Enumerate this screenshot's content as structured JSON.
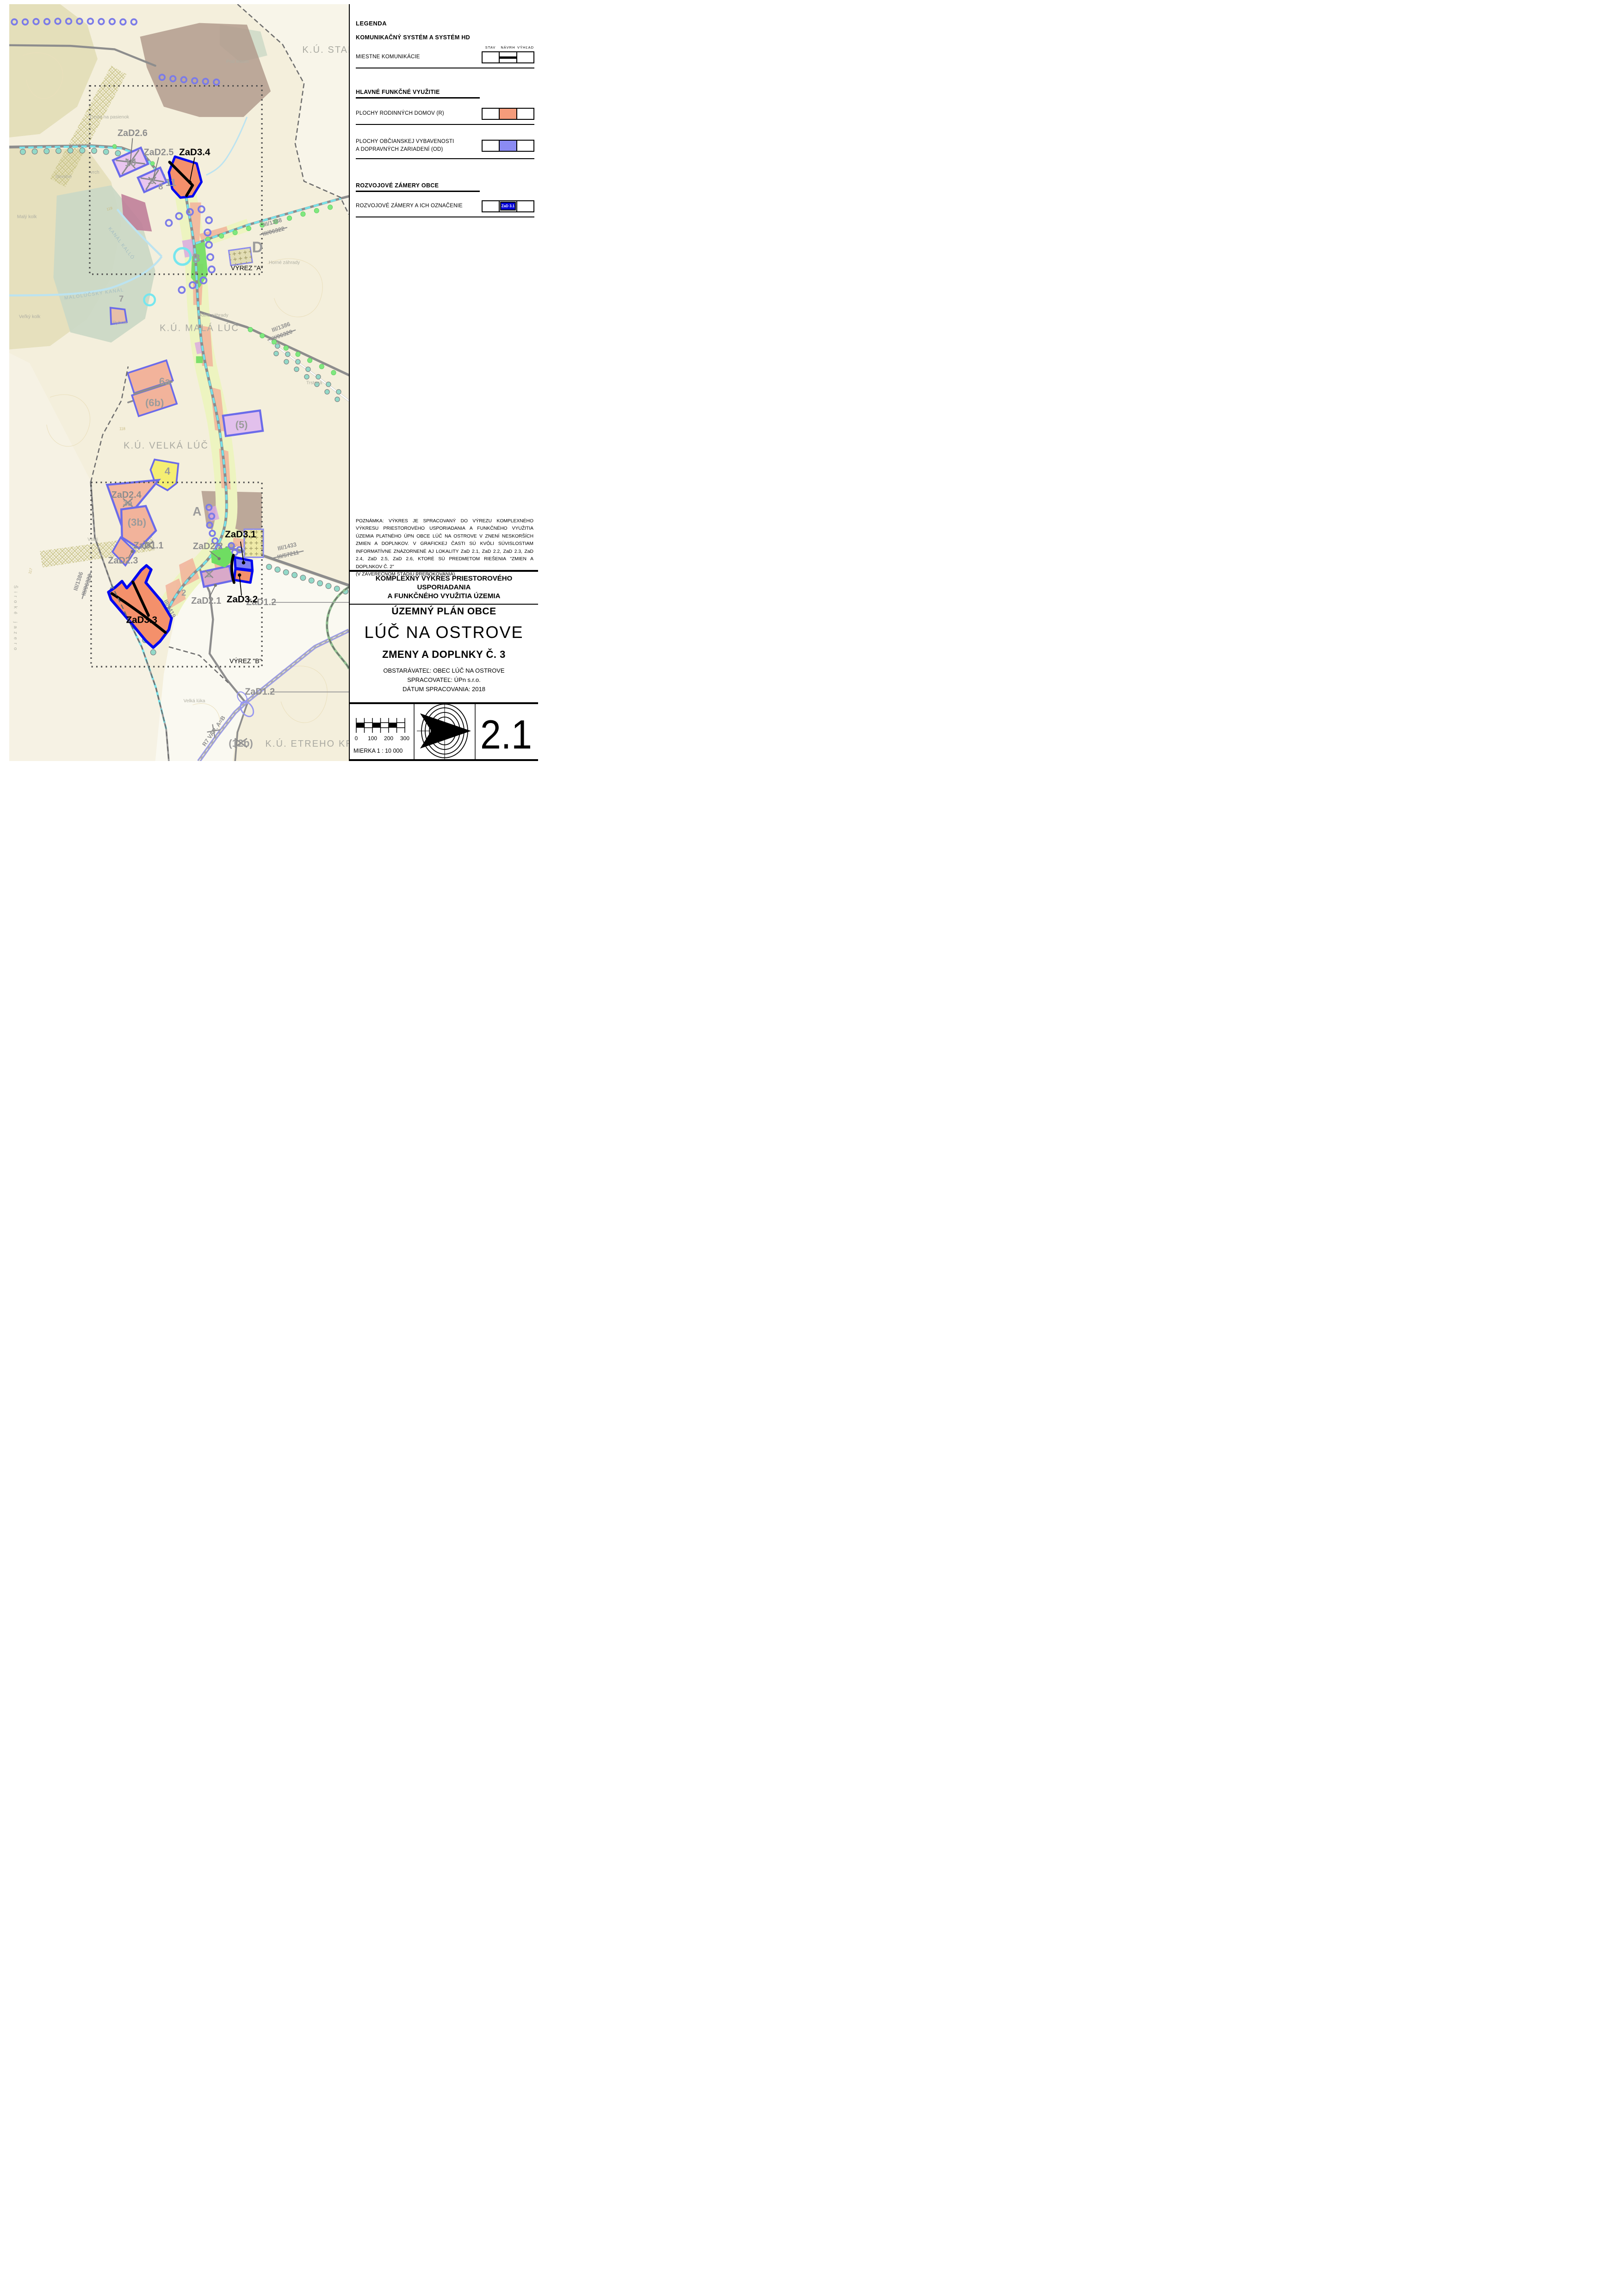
{
  "sheet": {
    "number": "2.1",
    "scale_label": "MIERKA 1 : 10 000",
    "scale_ticks": [
      "0",
      "100",
      "200",
      "300"
    ]
  },
  "legend": {
    "title": "LEGENDA",
    "columns": [
      "STAV",
      "NÁVRH",
      "VÝHĽAD"
    ],
    "sections": [
      {
        "title": "KOMUNIKAČNÝ SYSTÉM A SYSTÉM HD",
        "rows": [
          {
            "label": "MIESTNE KOMUNIKÁCIE",
            "symbol": "road-line"
          }
        ]
      },
      {
        "title": "HLAVNÉ FUNKČNÉ VYUŽITIE",
        "rows": [
          {
            "label": "PLOCHY RODINNÝCH DOMOV (R)",
            "symbol": "swatch",
            "color": "#F59C7B"
          },
          {
            "label": "PLOCHY OBČIANSKEJ VYBAVENOSTI",
            "label2": "A DOPRAVNÝCH ZARIADENÍ (OD)",
            "symbol": "swatch",
            "color": "#8B8BF3"
          }
        ]
      },
      {
        "title": "ROZVOJOVÉ ZÁMERY OBCE",
        "rows": [
          {
            "label": "ROZVOJOVÉ ZÁMERY A ICH OZNAČENIE",
            "symbol": "zad-box",
            "color": "#0000D6",
            "text": "ZaD 3.1"
          }
        ]
      }
    ]
  },
  "note": {
    "text": "POZNÁMKA: VÝKRES  JE SPRACOVANÝ DO VÝREZU KOMPLEXNÉHO VÝKRESU PRIESTOROVÉHO USPORIADANIA A FUNKČNÉHO VYUŽITIA ÚZEMIA  PLATNÉHO ÚPN OBCE LÚČ NA OSTROVE V ZNENÍ NESKORŠÍCH ZMIEN A DOPLNKOV. V GRAFICKEJ ČASTI SÚ KVÔLI SÚVISLOSTIAM INFORMATÍVNE ZNÁZORNENÉ AJ LOKALITY ZaD 2.1, ZaD 2.2, ZaD 2.3, ZaD 2.4, ZaD 2.5, ZaD 2.6, KTORÉ SÚ PREDMETOM RIEŠENIA \"ZMIEN A DOPLNKOV Č. 2\"",
    "text2": "(V ZÁVEREČNOM ŠTÁDIU PREROKOVANIA)."
  },
  "titles": {
    "block1_line1": "KOMPLEXNÝ VÝKRES PRIESTOROVÉHO",
    "block1_line2": "USPORIADANIA",
    "block1_line3": "A FUNKČNÉHO VYUŽITIA ÚZEMIA",
    "plan_type": "ÚZEMNÝ PLÁN OBCE",
    "municipality": "LÚČ NA OSTROVE",
    "amendment": "ZMENY A DOPLNKY Č. 3",
    "client": "OBSTARÁVATEĽ: OBEC LÚČ NA OSTROVE",
    "author": "SPRACOVATEĽ: ÚPn s.r.o.",
    "date": "DÁTUM  SPRACOVANIA: 2018"
  },
  "map": {
    "labels": {
      "ku_stara": "K.Ú. STARÁ",
      "ku_mala": "K.Ú. MALÁ LÚČ",
      "ku_velka": "K.Ú. VELKÁ LÚČ",
      "ku_etreho": "K.Ú. ETREHO KRAČA",
      "zad2_6": "ZaD2.6",
      "zad2_5": "ZaD2.5",
      "zad2_4": "ZaD2.4",
      "zad2_3": "ZaD2.3",
      "zad2_2": "ZaD2.2",
      "zad2_1": "ZaD2.1",
      "zad1_1": "ZaD1.1",
      "zad1_2a": "ZaD1.2",
      "zad1_2b": "ZaD1.2",
      "zad3_1": "ZaD3.1",
      "zad3_2": "ZaD3.2",
      "zad3_3": "ZaD3.3",
      "zad3_4": "ZaD3.4",
      "n10": "10",
      "n9": "9",
      "n11": "11",
      "n8": "8",
      "n7": "7",
      "n6a": "6a",
      "n6b": "(6b)",
      "n5": "(5)",
      "n4": "4",
      "n3a": "3a",
      "n3b": "(3b)",
      "n2a": "2",
      "n2b": "2",
      "n12b": "(12b)",
      "letter_d": "D",
      "letter_b": "B",
      "letter_a": "A",
      "r1388": "III/1388",
      "r06322": "III/06322",
      "r1386a": "III/1386",
      "r06320a": "III/06320",
      "r1386b": "III/1386",
      "r06320b": "III/06320",
      "r1433": "III/1433",
      "r57211": "III/57211",
      "r1419": "III/1419",
      "r7": "R7 VAR. A=B",
      "vyrez_a": "VÝREZ \"A\"",
      "vyrez_b": "VÝREZ \"B\"",
      "horne": "Horné záhrady",
      "dolne": "Dolné záhrady",
      "velka_luka": "Velká lúka",
      "rybnik": "Rybník",
      "stredne": "Stredné",
      "cesta": "Cesta na pasienok",
      "trstena": "Trstená",
      "vrch": "vrch",
      "maly_kolk": "Malý kolk",
      "velky_kolk": "Veľký kolk",
      "pod_lesom": "Pod lesom",
      "vtaci": "Vtáči",
      "siroke": "Široké jazero",
      "kanal1": "KANÁL KALLÓ",
      "kanal2": "MALOLÚČSKY KANÁL",
      "c119": "119",
      "c118": "118",
      "c117": "117"
    },
    "colors": {
      "residential_salmon": "#F4906B",
      "civic_blue": "#8080EE",
      "zad_border_blue": "#0008F0",
      "parcel_violet_border": "#6B6BEA",
      "village_strip": "#EDF4C0",
      "road_gray": "#8D8D8D",
      "water_cyan": "#76E6EE",
      "base_beige": "#F4EFDC"
    }
  }
}
